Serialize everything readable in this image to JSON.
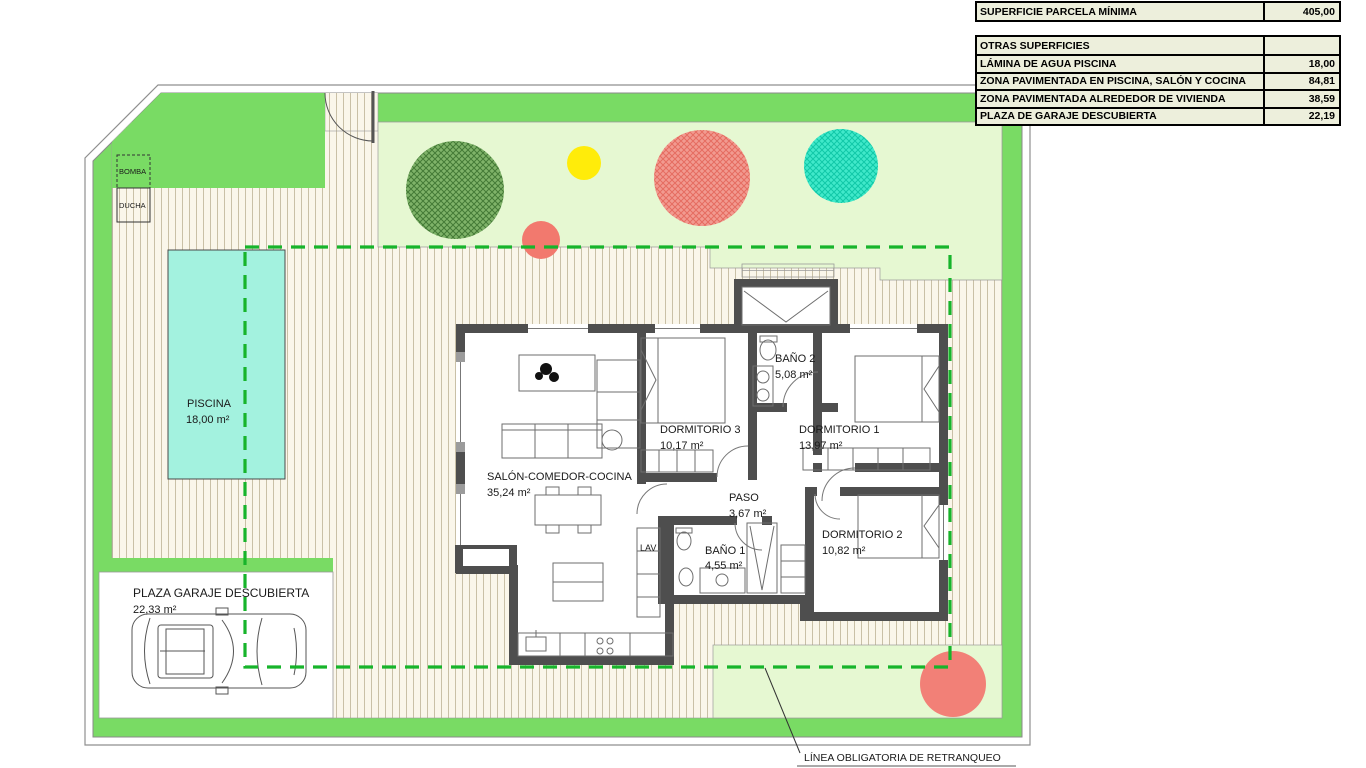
{
  "table": {
    "parcela": {
      "label": "SUPERFICIE PARCELA MÍNIMA",
      "value": "405,00"
    },
    "otras_header": {
      "label": "OTRAS SUPERFICIES",
      "value": ""
    },
    "rows": [
      {
        "label": "LÁMINA DE AGUA PISCINA",
        "value": "18,00"
      },
      {
        "label": "ZONA PAVIMENTADA EN PISCINA, SALÓN Y COCINA",
        "value": "84,81"
      },
      {
        "label": "ZONA PAVIMENTADA ALREDEDOR DE VIVIENDA",
        "value": "38,59"
      },
      {
        "label": "PLAZA DE GARAJE DESCUBIERTA",
        "value": "22,19"
      }
    ]
  },
  "plan": {
    "rooms": {
      "piscina": {
        "name": "PISCINA",
        "area": "18,00 m²"
      },
      "salon": {
        "name": "SALÓN-COMEDOR-COCINA",
        "area": "35,24 m²"
      },
      "dormitorio3": {
        "name": "DORMITORIO 3",
        "area": "10,17 m²"
      },
      "bano2": {
        "name": "BAÑO 2",
        "area": "5,08 m²"
      },
      "dormitorio1": {
        "name": "DORMITORIO 1",
        "area": "13,97 m²"
      },
      "paso": {
        "name": "PASO",
        "area": "3,67 m²"
      },
      "bano1": {
        "name": "BAÑO 1",
        "area": "4,55 m²"
      },
      "dormitorio2": {
        "name": "DORMITORIO 2",
        "area": "10,82 m²"
      },
      "garaje": {
        "name": "PLAZA GARAJE DESCUBIERTA",
        "area": "22,33 m²"
      }
    },
    "labels": {
      "lav": "LAV",
      "bomba": "BOMBA",
      "ducha": "DUCHA",
      "retranqueo": "LÍNEA OBLIGATORIA DE RETRANQUEO"
    },
    "colors": {
      "grass_green": "#79DB64",
      "pale_green": "#E6F8D2",
      "paving_cream": "#FAF6EA",
      "pool_cyan": "#A3F2DF",
      "setback_dash_green": "#17B42B",
      "wall_gray": "#4E4E4E",
      "table_bg": "#EDEFDC",
      "tree_dark_green": "#7FB369",
      "tree_salmon": "#F29A90",
      "tree_teal": "#40E9CA",
      "tree_yellow": "#FFEC0A"
    }
  }
}
